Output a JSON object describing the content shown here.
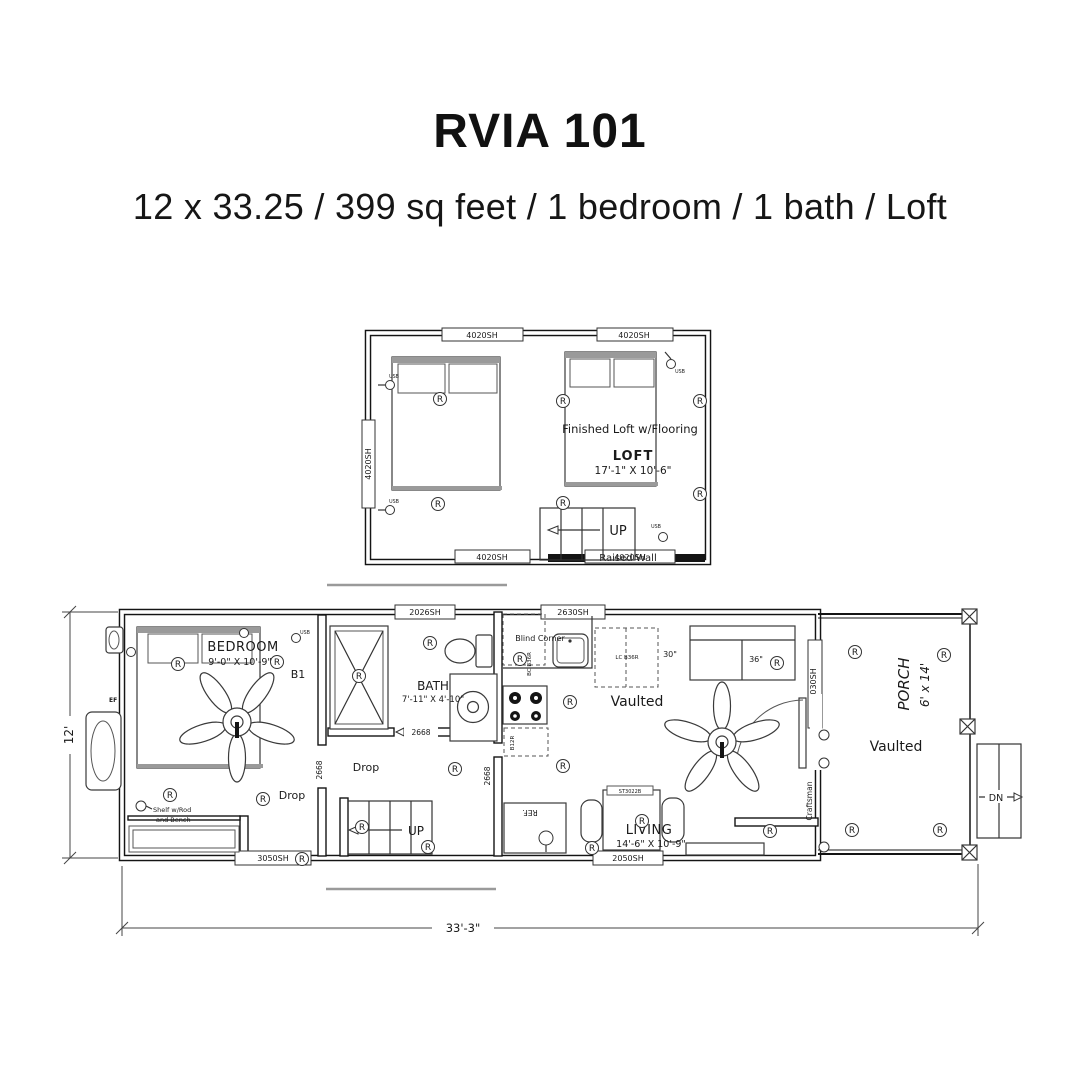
{
  "header": {
    "title": "RVIA 101",
    "subtitle": "12 x 33.25 / 399 sq feet / 1 bedroom / 1 bath / Loft"
  },
  "symbols": {
    "recessed_light": "R",
    "usb": "USB",
    "up": "UP",
    "down": "DN",
    "exhaust_fan": "EF"
  },
  "loft": {
    "windows": {
      "top_left": "4020SH",
      "top_right": "4020SH",
      "left": "4020SH",
      "bottom": "4020SH",
      "bottom_right": "4020SH"
    },
    "raised_wall": "Raised Wall",
    "flooring_note": "Finished Loft w/Flooring",
    "name": "LOFT",
    "dims": "17'-1\" X 10'-6\""
  },
  "main": {
    "bedroom": {
      "name": "BEDROOM",
      "dims": "9'-0\" X 10'-9\"",
      "tag": "B1",
      "drop": "Drop",
      "closet_line1": "Shelf w/Rod",
      "closet_line2": "and Bench"
    },
    "hall": {
      "drop": "Drop"
    },
    "bath": {
      "name": "BATH",
      "dims": "7'-11\" X 4'-10\""
    },
    "kitchen": {
      "blind_corner": "Blind Corner",
      "bc_cab": "BC B36R",
      "lc_cab": "LC B36R",
      "upper_30": "30\"",
      "base_b12": "B12R",
      "fridge": "REF."
    },
    "living": {
      "name": "LIVING",
      "dims": "14'-6\" X 10'-9\"",
      "sofa": "36\"",
      "table_tag": "ST3022B",
      "vaulted": "Vaulted"
    },
    "porch": {
      "name": "PORCH",
      "dims": "6' x 14'",
      "vaulted": "Vaulted"
    },
    "windows": {
      "w2026": "2026SH",
      "w2630": "2630SH",
      "w3030": "3030SH",
      "w3050": "3050SH",
      "w2050": "2050SH"
    },
    "doors": {
      "pocket": "2668",
      "front": "Craftsman"
    }
  },
  "dims": {
    "width": "12'",
    "length": "33'-3\""
  }
}
